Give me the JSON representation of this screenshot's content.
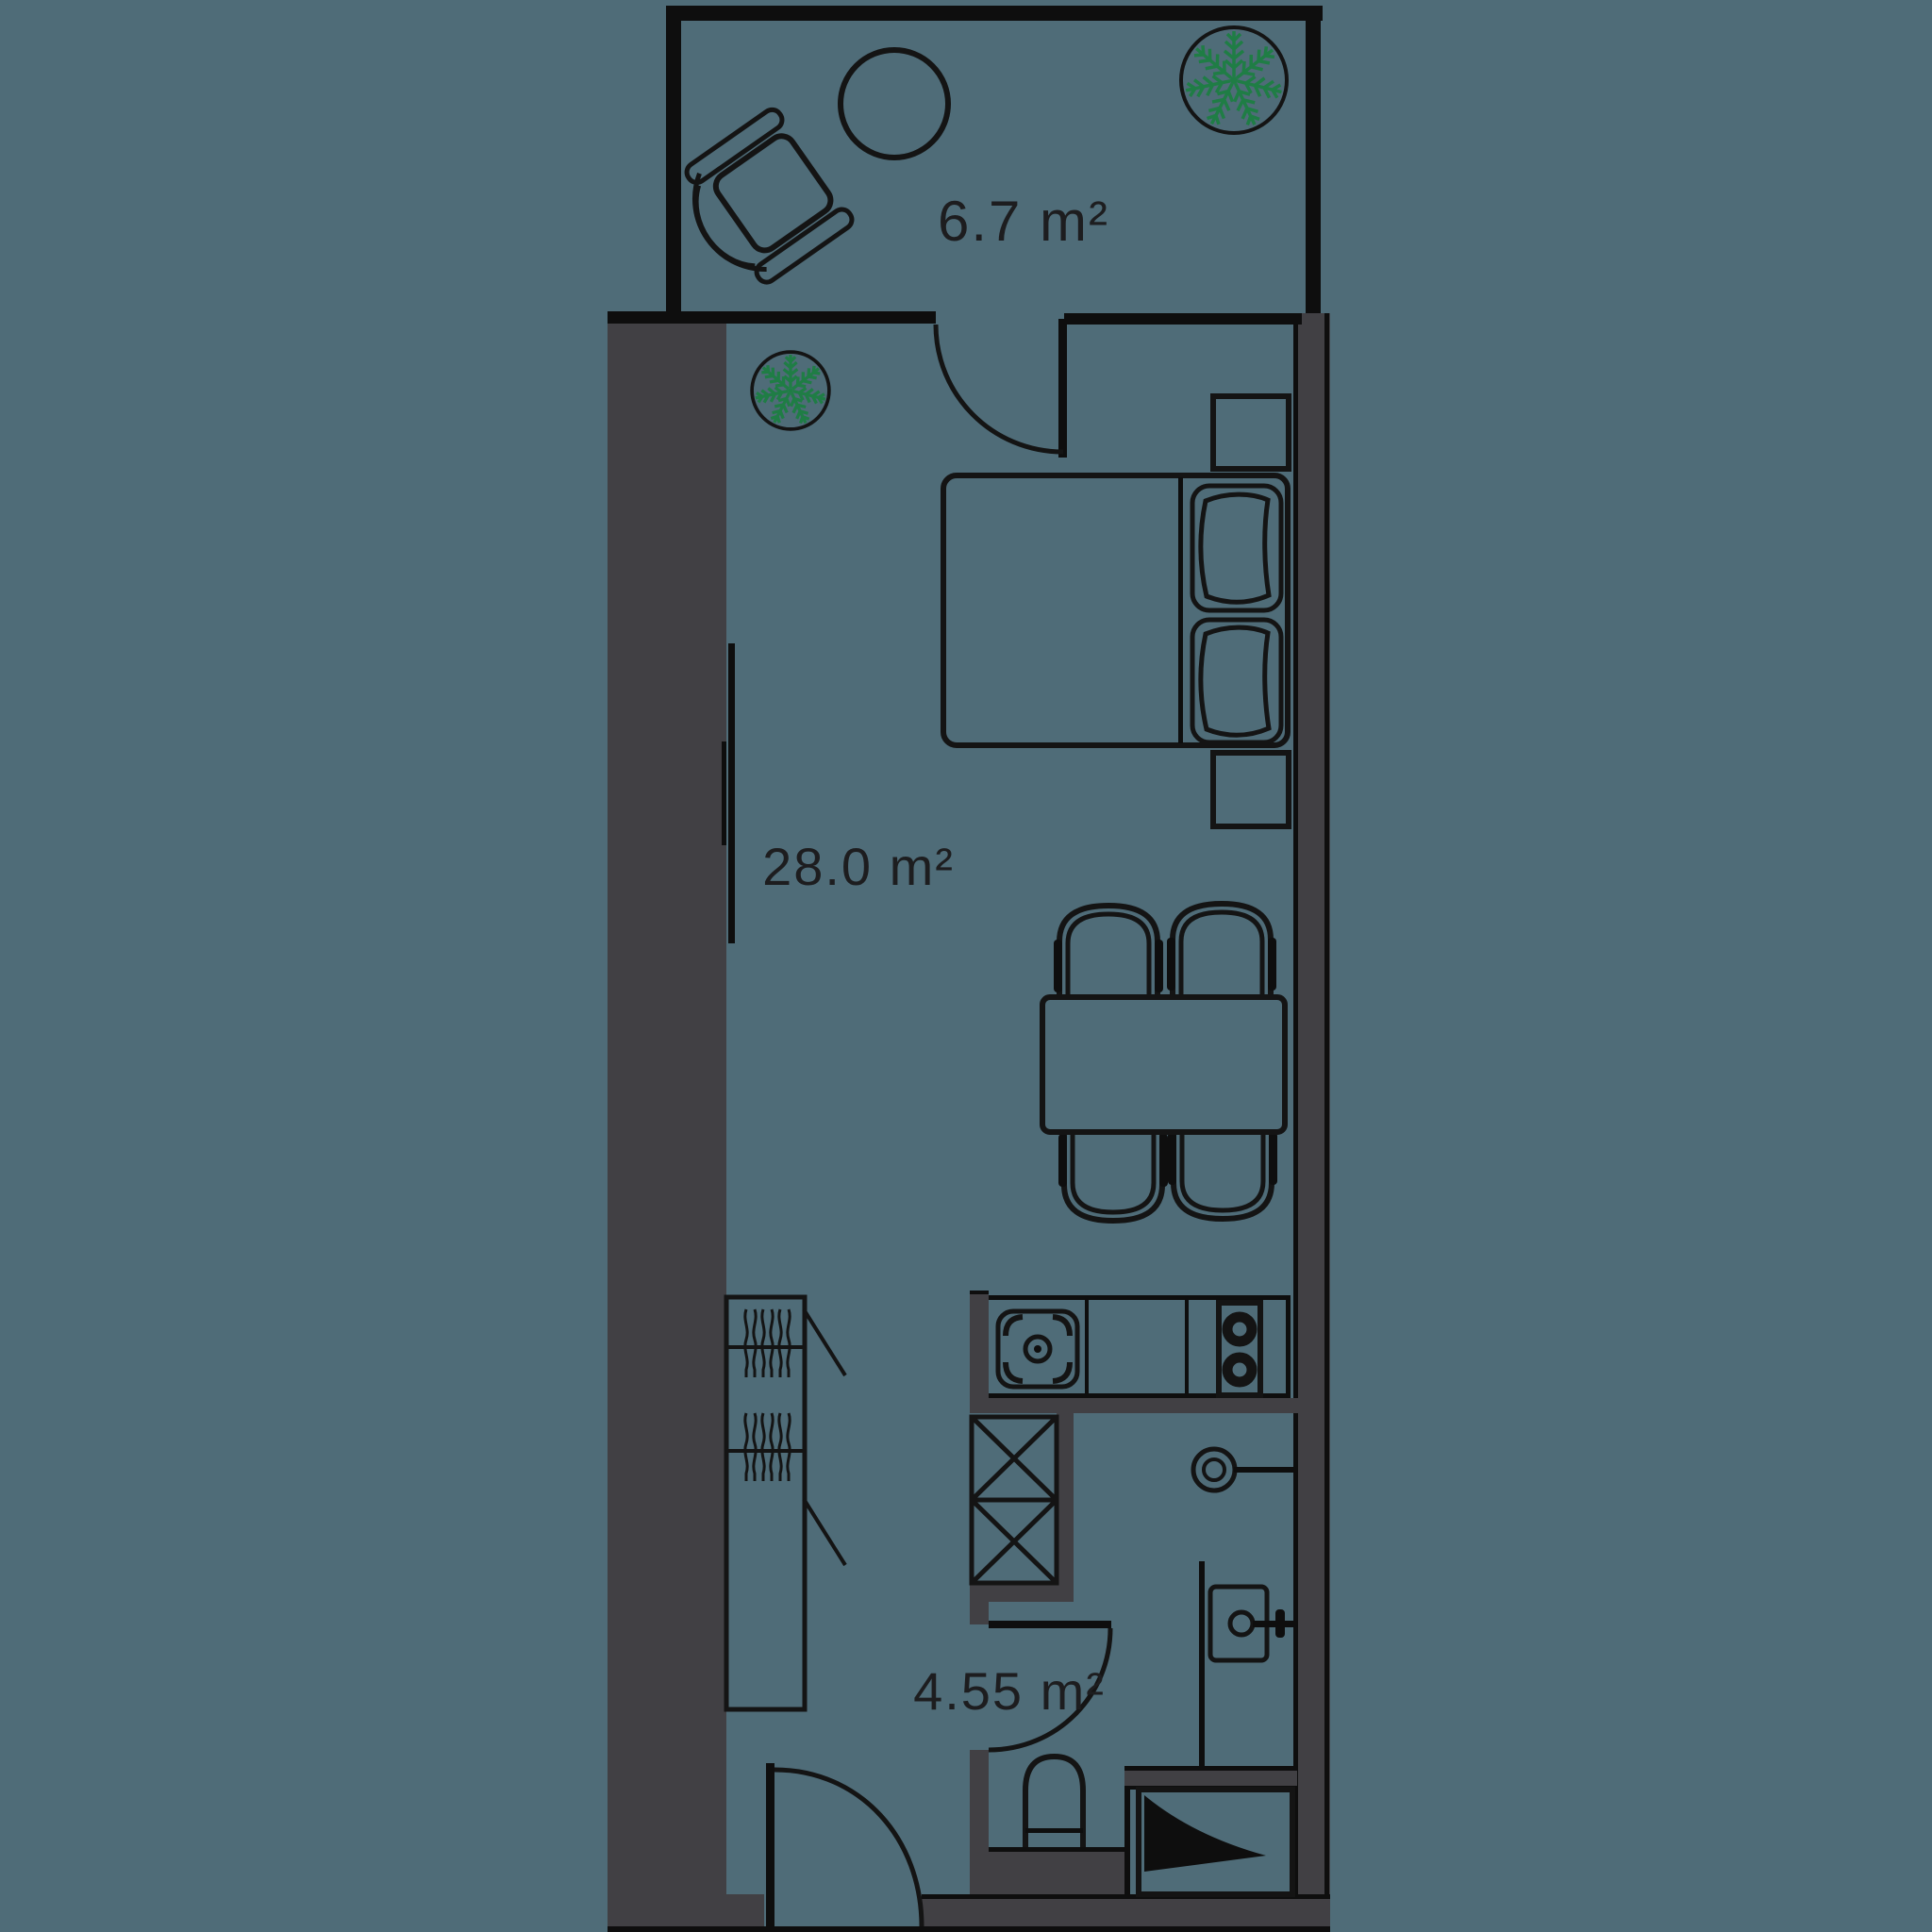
{
  "type": "floor-plan",
  "rooms": [
    {
      "name": "balcony",
      "area_label": "6.7 m²"
    },
    {
      "name": "main-room",
      "area_label": "28.0 m²"
    },
    {
      "name": "bathroom",
      "area_label": "4.55 m²"
    }
  ],
  "colors": {
    "background": "#4f6c78",
    "wall_gray": "#414044",
    "wall_black": "#0e0e0e",
    "furniture_line": "#141414",
    "plant_green": "#1f7d45",
    "text": "#1d1d1f"
  },
  "symbols": [
    "armchair",
    "round-table",
    "potted-plant-large",
    "potted-plant-small",
    "balcony-door",
    "tv",
    "double-bed",
    "pillow-top",
    "pillow-bottom",
    "nightstand-top",
    "nightstand-bottom",
    "dining-table",
    "chair-top-left",
    "chair-top-right",
    "chair-bottom-left",
    "chair-bottom-right",
    "wardrobe",
    "kitchen-counter",
    "kitchen-sink",
    "cooktop",
    "ventilation-shaft",
    "bathroom-door",
    "entry-door",
    "shower-head",
    "washbasin",
    "toilet",
    "shower-tray"
  ]
}
